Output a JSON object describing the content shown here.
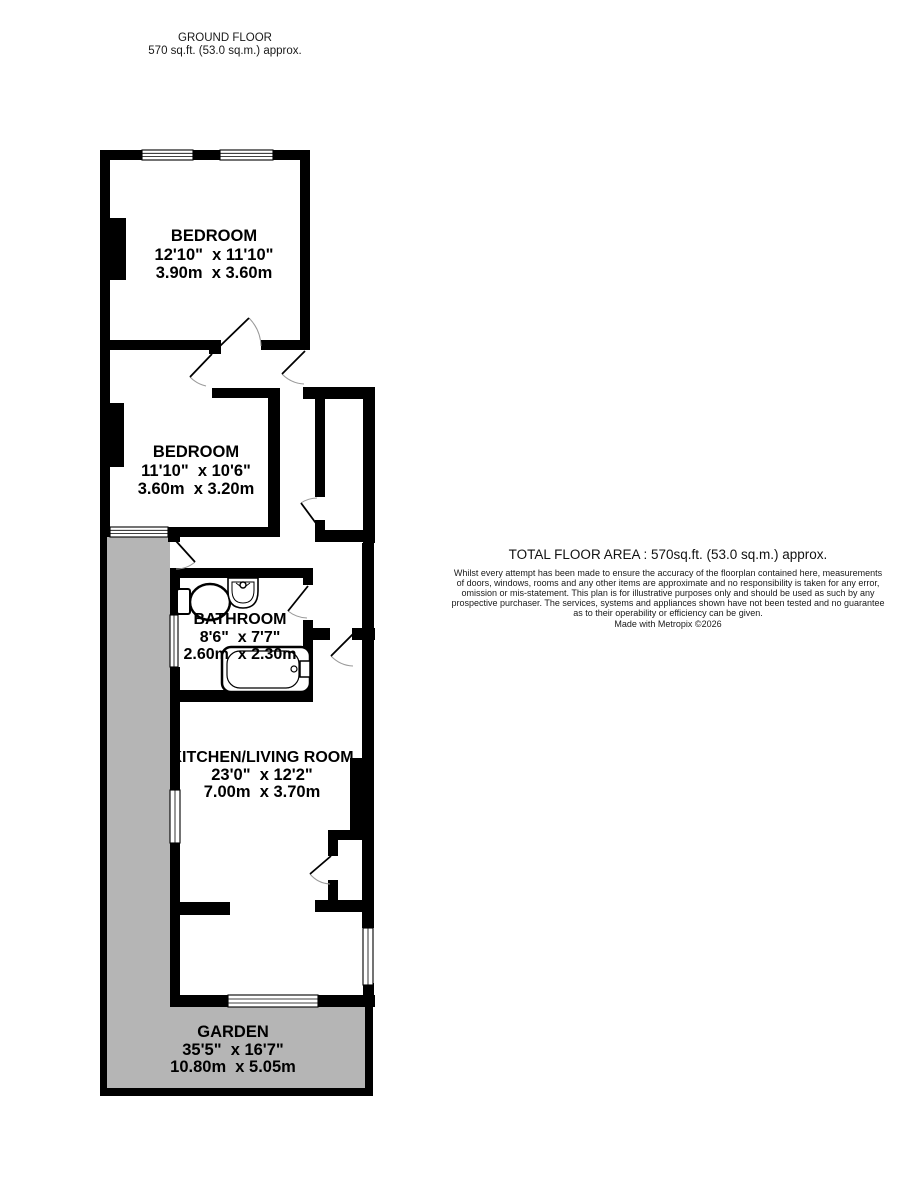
{
  "header": {
    "line1": "GROUND FLOOR",
    "line2": "570 sq.ft. (53.0 sq.m.) approx."
  },
  "rooms": {
    "bedroom1": {
      "name": "BEDROOM",
      "imperial": "12'10\"  x 11'10\"",
      "metric": "3.90m  x 3.60m"
    },
    "bedroom2": {
      "name": "BEDROOM",
      "imperial": "11'10\"  x 10'6\"",
      "metric": "3.60m  x 3.20m"
    },
    "bathroom": {
      "name": "BATHROOM",
      "imperial": "8'6\"  x 7'7\"",
      "metric": "2.60m  x 2.30m"
    },
    "kitchen": {
      "name": "KITCHEN/LIVING ROOM",
      "imperial": "23'0\"  x 12'2\"",
      "metric": "7.00m  x 3.70m"
    },
    "garden": {
      "name": "GARDEN",
      "imperial": "35'5\"  x 16'7\"",
      "metric": "10.80m  x 5.05m"
    }
  },
  "footer": {
    "total": "TOTAL FLOOR AREA : 570sq.ft. (53.0 sq.m.) approx.",
    "disclaimer_lines": [
      "Whilst every attempt has been made to ensure the accuracy of the floorplan contained here, measurements",
      "of doors, windows, rooms and any other items are approximate and no responsibility is taken for any error,",
      "omission or mis-statement. This plan is for illustrative purposes only and should be used as such by any",
      "prospective purchaser. The services, systems and appliances shown have not been tested and no guarantee",
      "as to their operability or efficiency can be given."
    ],
    "credit": "Made with Metropix ©2026"
  },
  "colors": {
    "wall": "#000000",
    "garden": "#b5b5b5",
    "door_arc": "#999999",
    "text": "#000000"
  }
}
